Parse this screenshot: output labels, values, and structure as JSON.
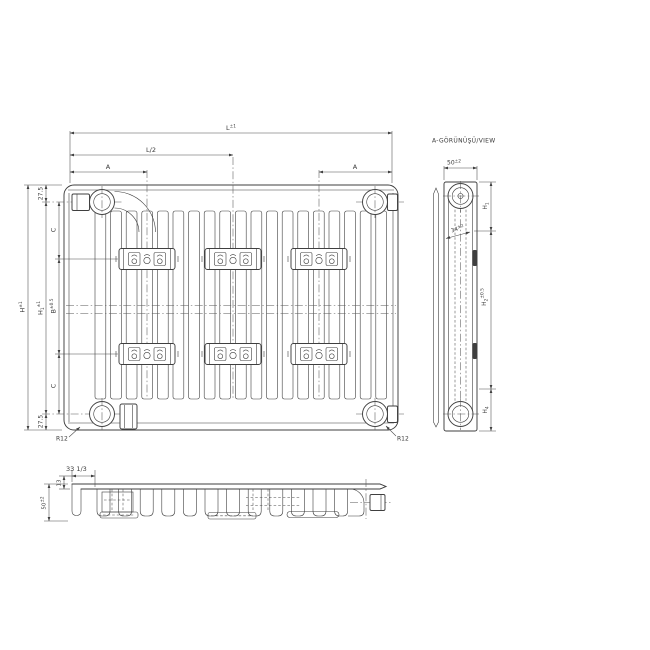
{
  "front_view": {
    "dim_length": {
      "base": "L",
      "tol": "±1"
    },
    "dim_half_length": "L/2",
    "dim_a_left": "A",
    "dim_a_right": "A",
    "dim_height_overall": {
      "base": "H",
      "tol": "±1"
    },
    "dim_height_connections": {
      "base": "H",
      "sub": "1",
      "tol": "±1"
    },
    "dim_top_offset": "27.5",
    "dim_bottom_offset": "27.5",
    "dim_c_top": "C",
    "dim_c_bottom": "C",
    "dim_bracket_spacing": {
      "base": "B",
      "tol": "±0.5"
    },
    "corner_radius_left": "R12",
    "corner_radius_right": "R12"
  },
  "side_view": {
    "title": "A-GÖRÜNÜŞÜ/VIEW",
    "dim_depth": {
      "base": "50",
      "tol": "±2"
    },
    "dim_pipe_spacing": {
      "base": "34",
      "tol": "±2"
    },
    "dim_h1": {
      "base": "H",
      "sub": "1"
    },
    "dim_h2": {
      "base": "H",
      "sub": "2",
      "tol": "±0.5"
    },
    "dim_h4": {
      "base": "H",
      "sub": "4"
    }
  },
  "bottom_view": {
    "dim_fin_pitch": "33 1/3",
    "dim_panel_depth": "13",
    "dim_total_depth": {
      "base": "50",
      "tol": "±2"
    }
  },
  "colors": {
    "line": "#3f3f3f",
    "background": "#ffffff"
  }
}
